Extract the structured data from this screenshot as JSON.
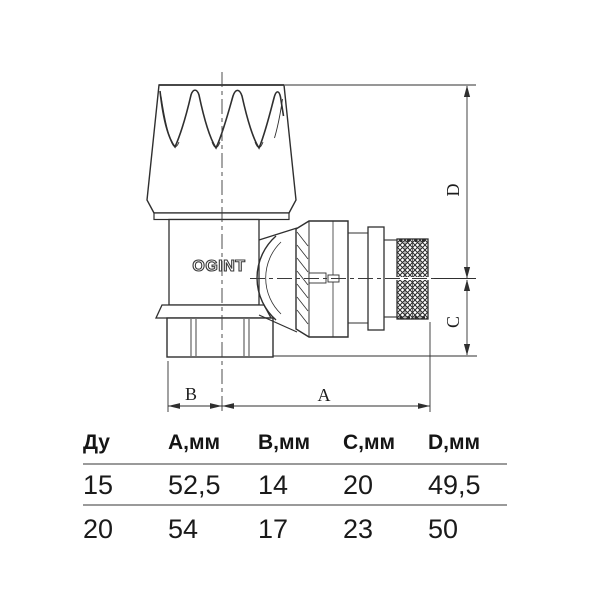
{
  "drawing": {
    "brand": "OGINT",
    "labels": {
      "a": "A",
      "b": "B",
      "c": "C",
      "d": "D"
    }
  },
  "table": {
    "headers": [
      "Ду",
      "А,мм",
      "В,мм",
      "С,мм",
      "D,мм"
    ],
    "rows": [
      [
        "15",
        "52,5",
        "14",
        "20",
        "49,5"
      ],
      [
        "20",
        "54",
        "17",
        "23",
        "50"
      ]
    ]
  },
  "colors": {
    "line": "#2f2f2f",
    "table_rule": "#9a9a9a",
    "text": "#111111",
    "background": "#ffffff"
  }
}
